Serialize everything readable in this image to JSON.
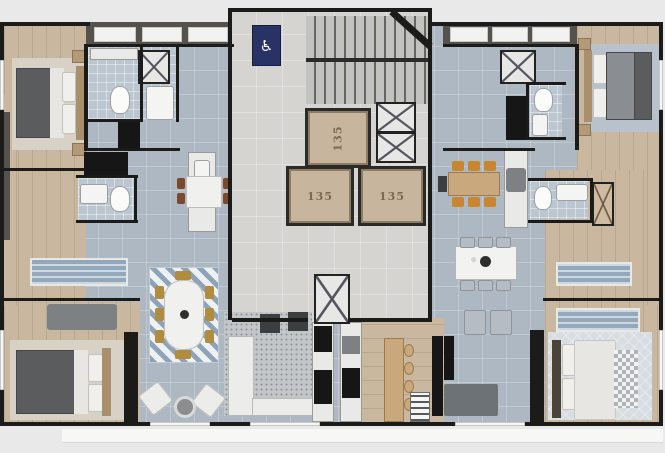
{
  "scene": {
    "type": "architectural-floor-plan",
    "view": "top-down-render"
  },
  "core": {
    "elevators": [
      {
        "label": "135"
      },
      {
        "label": "135"
      },
      {
        "label": "135"
      }
    ],
    "accessibility_sign": {
      "icon": "wheelchair-icon",
      "glyph": "♿"
    }
  },
  "colors": {
    "background": "#e9e9e9",
    "walls": "#1b1b1a",
    "wood_floor": "#c9b7a0",
    "tile_floor": "#aeb8c3",
    "core_floor": "#d5d4d1",
    "bath_tile": "#bcc6d0",
    "balcony_deck": "#55524d",
    "accessibility_navy": "#283264",
    "elevator_cabin": "#c7b59d",
    "chair_brown": "#7a4a2b",
    "chair_gold": "#b08d3e",
    "chair_mustard": "#c8862e"
  }
}
